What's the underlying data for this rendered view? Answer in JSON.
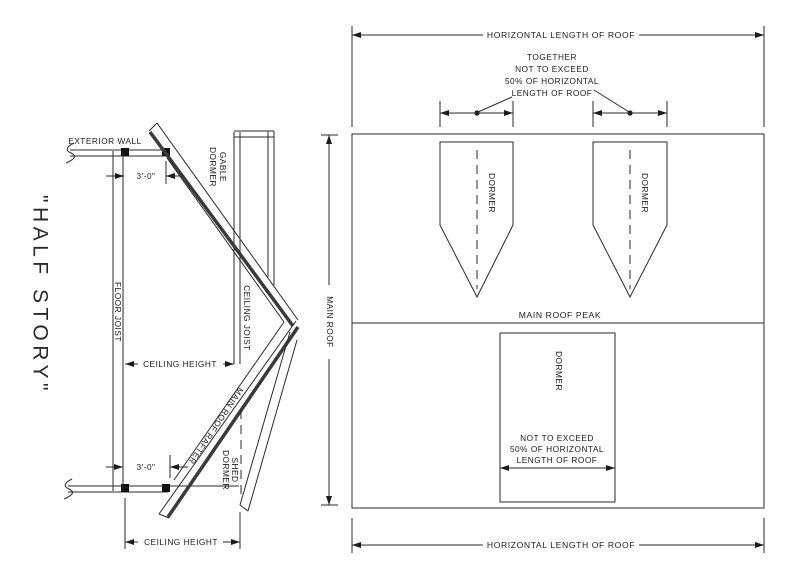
{
  "title": "\"HALF STORY\"",
  "left_section": {
    "exterior_wall": "EXTERIOR WALL",
    "gable_dormer_line1": "GABLE",
    "gable_dormer_line2": "DORMER",
    "floor_joist": "FLOOR JOIST",
    "ceiling_joist": "CEILING JOIST",
    "main_roof_rafter": "MAIN ROOF RAFTER",
    "shed_dormer_line1": "SHED",
    "shed_dormer_line2": "DORMER",
    "knee_wall_dim_top": "3'-0\"",
    "knee_wall_dim_bottom": "3'-0\"",
    "ceiling_height_dim_top": "CEILING HEIGHT",
    "ceiling_height_dim_bottom": "CEILING HEIGHT"
  },
  "roof_plan": {
    "horizontal_length_top": "HORIZONTAL LENGTH OF ROOF",
    "horizontal_length_bottom": "HORIZONTAL LENGTH OF ROOF",
    "together_note_line1": "TOGETHER",
    "together_note_line2": "NOT TO EXCEED",
    "together_note_line3": "50% OF HORIZONTAL",
    "together_note_line4": "LENGTH OF ROOF",
    "main_roof_dim": "MAIN ROOF",
    "main_roof_peak": "MAIN ROOF PEAK",
    "dormer_left": "DORMER",
    "dormer_right": "DORMER",
    "shed_dormer": "DORMER",
    "shed_note_line1": "NOT TO EXCEED",
    "shed_note_line2": "50% OF HORIZONTAL",
    "shed_note_line3": "LENGTH OF ROOF"
  },
  "colors": {
    "ink": "#1c1c1c",
    "background": "#ffffff"
  }
}
